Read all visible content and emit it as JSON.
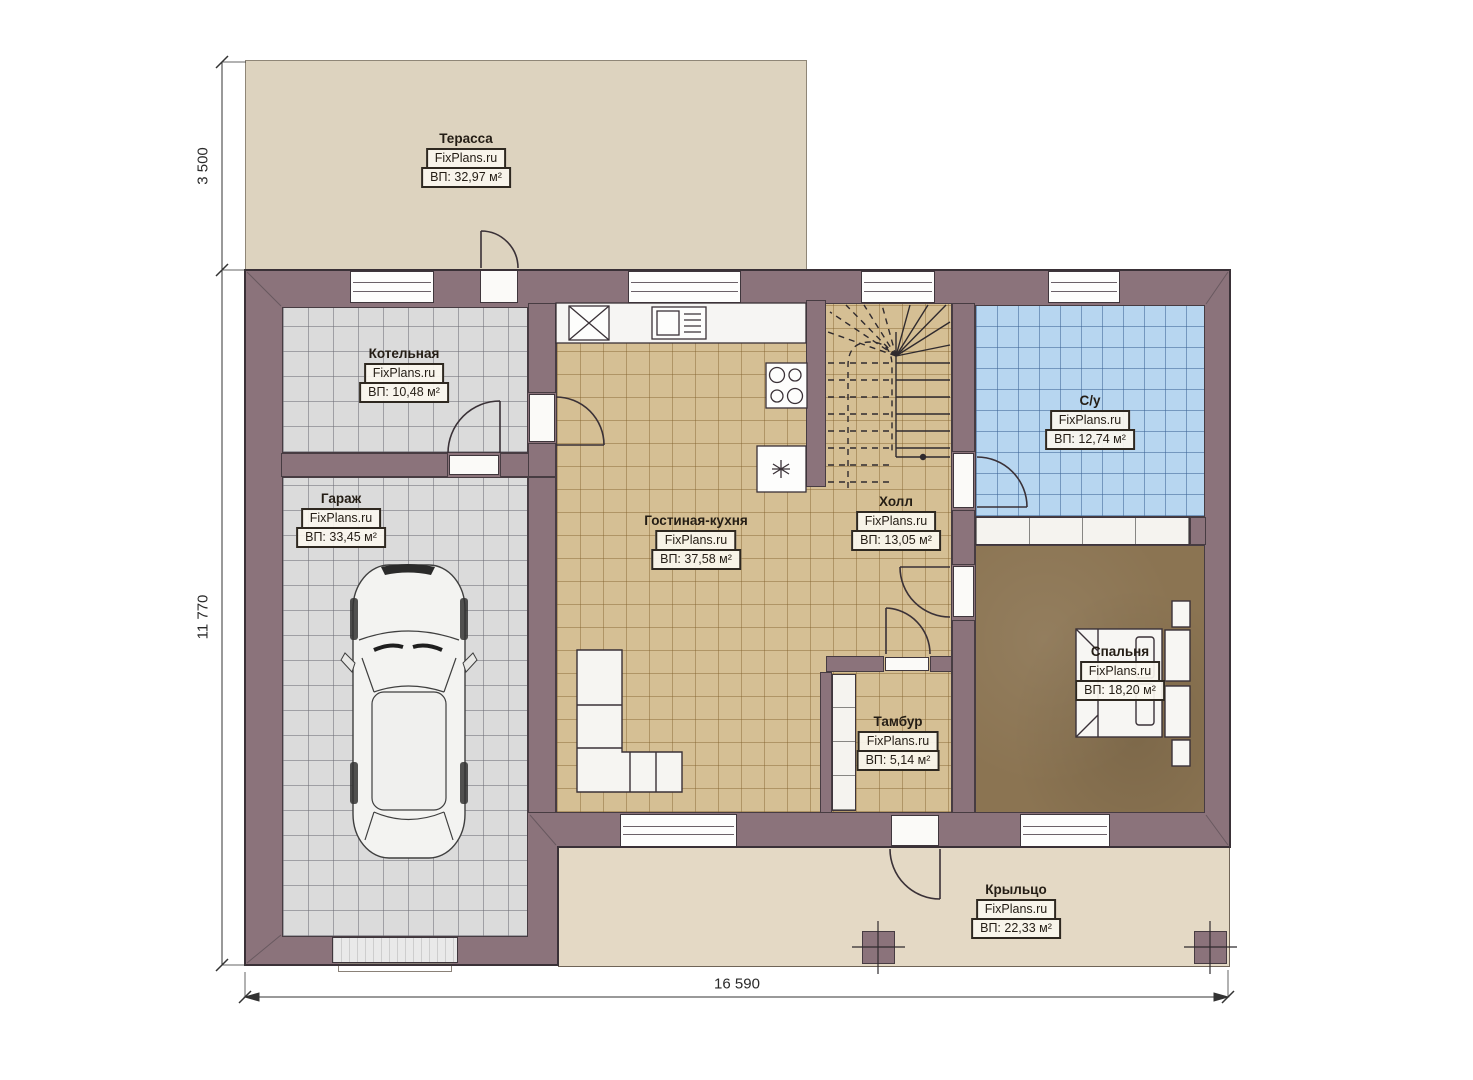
{
  "plan": {
    "site": "FixPlans.ru",
    "rooms": [
      {
        "id": "terrace",
        "name": "Терасса",
        "area": "ВП: 32,97 м²"
      },
      {
        "id": "boiler",
        "name": "Котельная",
        "area": "ВП: 10,48 м²"
      },
      {
        "id": "garage",
        "name": "Гараж",
        "area": "ВП: 33,45 м²"
      },
      {
        "id": "living",
        "name": "Гостиная-кухня",
        "area": "ВП: 37,58 м²"
      },
      {
        "id": "hall",
        "name": "Холл",
        "area": "ВП: 13,05 м²"
      },
      {
        "id": "bath",
        "name": "С/у",
        "area": "ВП: 12,74 м²"
      },
      {
        "id": "bedroom",
        "name": "Спальня",
        "area": "ВП: 18,20 м²"
      },
      {
        "id": "tambour",
        "name": "Тамбур",
        "area": "ВП: 5,14 м²"
      },
      {
        "id": "porch",
        "name": "Крыльцо",
        "area": "ВП: 22,33 м²"
      }
    ],
    "dimensions": {
      "terrace_height": "3 500",
      "house_height": "11 770",
      "house_width": "16 590"
    },
    "colors": {
      "wall": "#8b737b",
      "terrace_floor": "#ddd3bf",
      "porch_floor": "#e4d9c5",
      "tile_gray": "#dbdbdb",
      "tile_tan": "#d5bf94",
      "tile_blue": "#b7d6f0",
      "bedroom_floor": "#8b7452",
      "line": "#3a3137"
    }
  }
}
